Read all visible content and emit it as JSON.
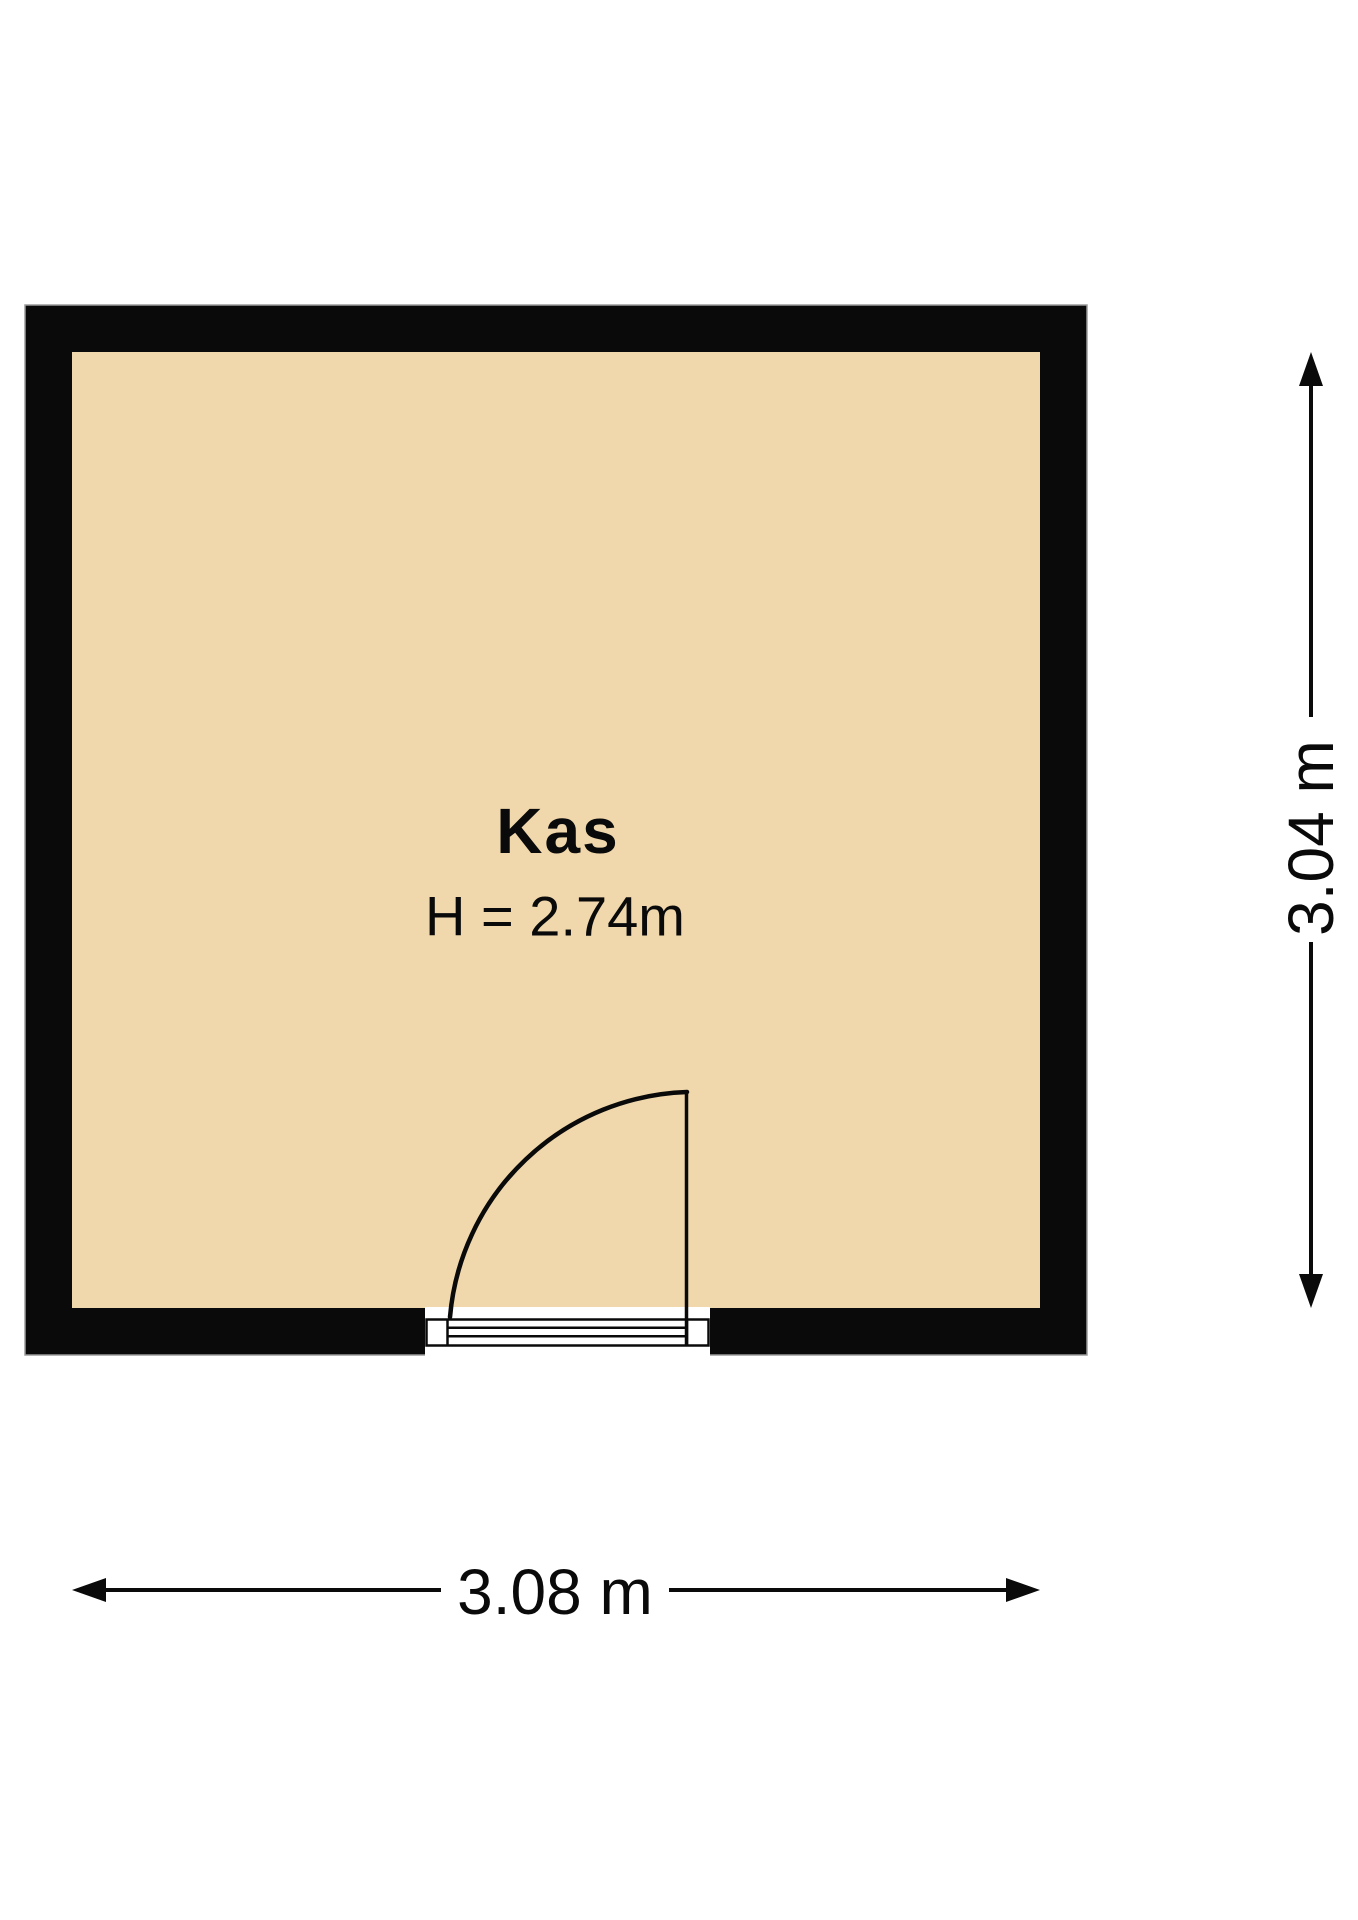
{
  "room": {
    "name": "Kas",
    "height_label": "H = 2.74m"
  },
  "dimensions": {
    "width": "3.08 m",
    "height": "3.04 m"
  },
  "colors": {
    "wall": "#0a0a0a",
    "wall_outline": "#9b9b9b",
    "floor": "#f0d8ac",
    "background": "#ffffff",
    "line": "#0a0a0a"
  }
}
